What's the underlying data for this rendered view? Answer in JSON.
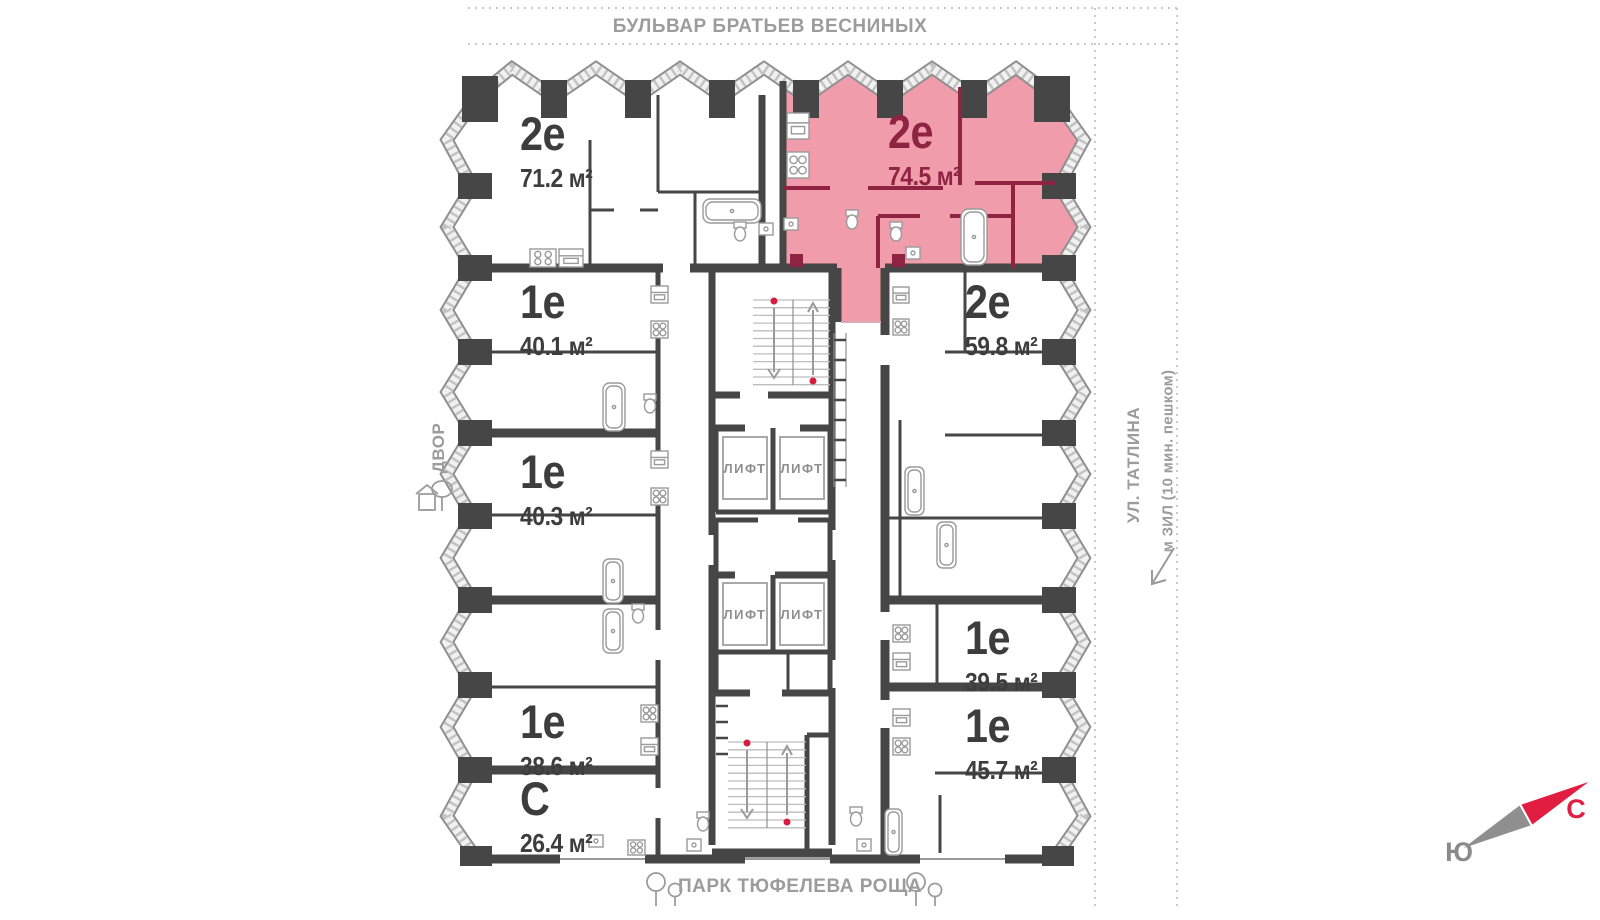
{
  "streets": {
    "top": "БУЛЬВАР БРАТЬЕВ ВЕСНИНЫХ",
    "right_street": "УЛ. ТАТЛИНА",
    "right_metro": "м ЗИЛ (10 мин. пешком)",
    "bottom_park": "ПАРК ТЮФЕЛЕВА РОЩА",
    "left_yard": "ДВОР"
  },
  "compass": {
    "north": "С",
    "south": "Ю"
  },
  "core": {
    "elevator_label": "ЛИФТ"
  },
  "apartments": [
    {
      "type": "2е",
      "area": "71.2 м²",
      "highlighted": false
    },
    {
      "type": "2е",
      "area": "74.5 м²",
      "highlighted": true
    },
    {
      "type": "2е",
      "area": "59.8 м²",
      "highlighted": false
    },
    {
      "type": "1е",
      "area": "40.1 м²",
      "highlighted": false
    },
    {
      "type": "1е",
      "area": "40.3 м²",
      "highlighted": false
    },
    {
      "type": "1е",
      "area": "38.6 м²",
      "highlighted": false
    },
    {
      "type": "С",
      "area": "26.4 м²",
      "highlighted": false
    },
    {
      "type": "1е",
      "area": "39.5 м²",
      "highlighted": false
    },
    {
      "type": "1е",
      "area": "45.7 м²",
      "highlighted": false
    }
  ],
  "colors": {
    "highlight_fill": "#F09CAB",
    "highlight_accent": "#8E2342",
    "wall": "#464646",
    "label": "#3D3D3D",
    "street_label": "#9C9C9C",
    "compass_north": "#E11D41",
    "fixture": "#9A9A9A"
  }
}
